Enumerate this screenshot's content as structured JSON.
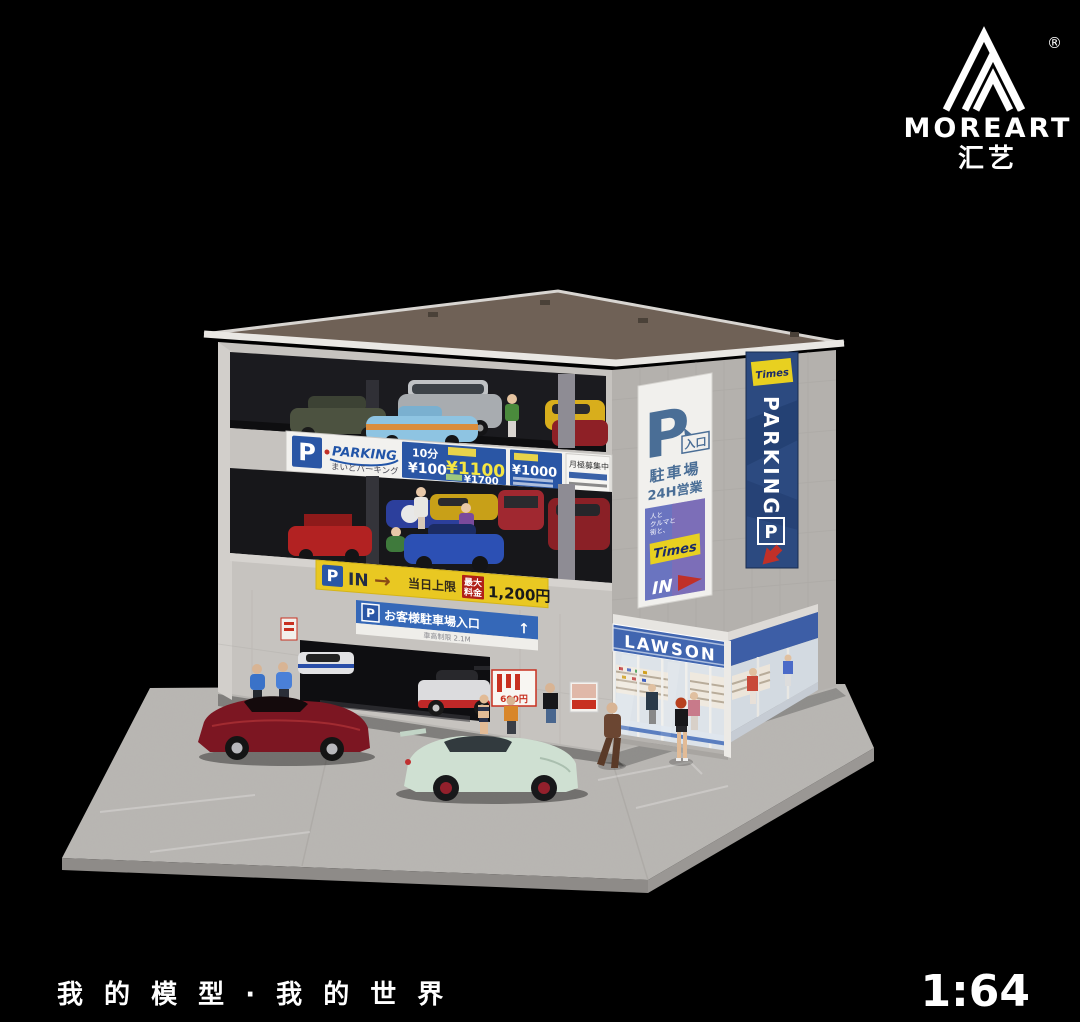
{
  "brand": {
    "name": "MOREART",
    "cn": "汇艺",
    "registered": "®"
  },
  "footer": {
    "tagline": "我 的 模 型 · 我 的 世 界",
    "scale": "1:64"
  },
  "signs": {
    "parking_banner": {
      "p": "P",
      "brand": "PARKING",
      "brand_sub": "まいどパーキング",
      "unit": "10分",
      "unit_price": "¥100",
      "day_max": "¥1100",
      "night_max": "¥1700",
      "sub_max": "¥1000",
      "monthly": "月極募集中"
    },
    "entry_banner": {
      "p": "P",
      "in_label": "IN",
      "arrow": "→",
      "day_limit": "当日上限",
      "max_line1": "最大",
      "max_line2": "料金",
      "price": "1,200円"
    },
    "customer_banner": {
      "p": "P",
      "label": "お客様駐車場入口",
      "arrow": "↑",
      "notice": "車高制限 2.1M"
    },
    "right_sign": {
      "p": "P",
      "entrance": "入口",
      "parking_lot": "駐車場",
      "hours": "24H営業",
      "slogan": [
        "人と",
        "クルマと",
        "街と、"
      ],
      "times": "Times",
      "in_label": "IN"
    },
    "flag": {
      "times": "Times",
      "parking": "PARKING",
      "p": "P"
    },
    "store": {
      "name": "LAWSON"
    },
    "poster": {
      "price": "600円"
    }
  },
  "colors": {
    "accent_blue": "#2a56a5",
    "sign_navy": "#4a6e96",
    "banner_yellow": "#e9c822",
    "lawson_blue": "#4166b0",
    "flag_navy": "#2c4a80",
    "times_yellow": "#e8d020",
    "arrow_red": "#c03028",
    "roof": "#6f6156",
    "wall_left": "#c6c3bf",
    "wall_right": "#b4b1ad",
    "base": "#b9b6b2",
    "car_dark_red": "#7c1622",
    "car_mint": "#cfe0d2"
  }
}
